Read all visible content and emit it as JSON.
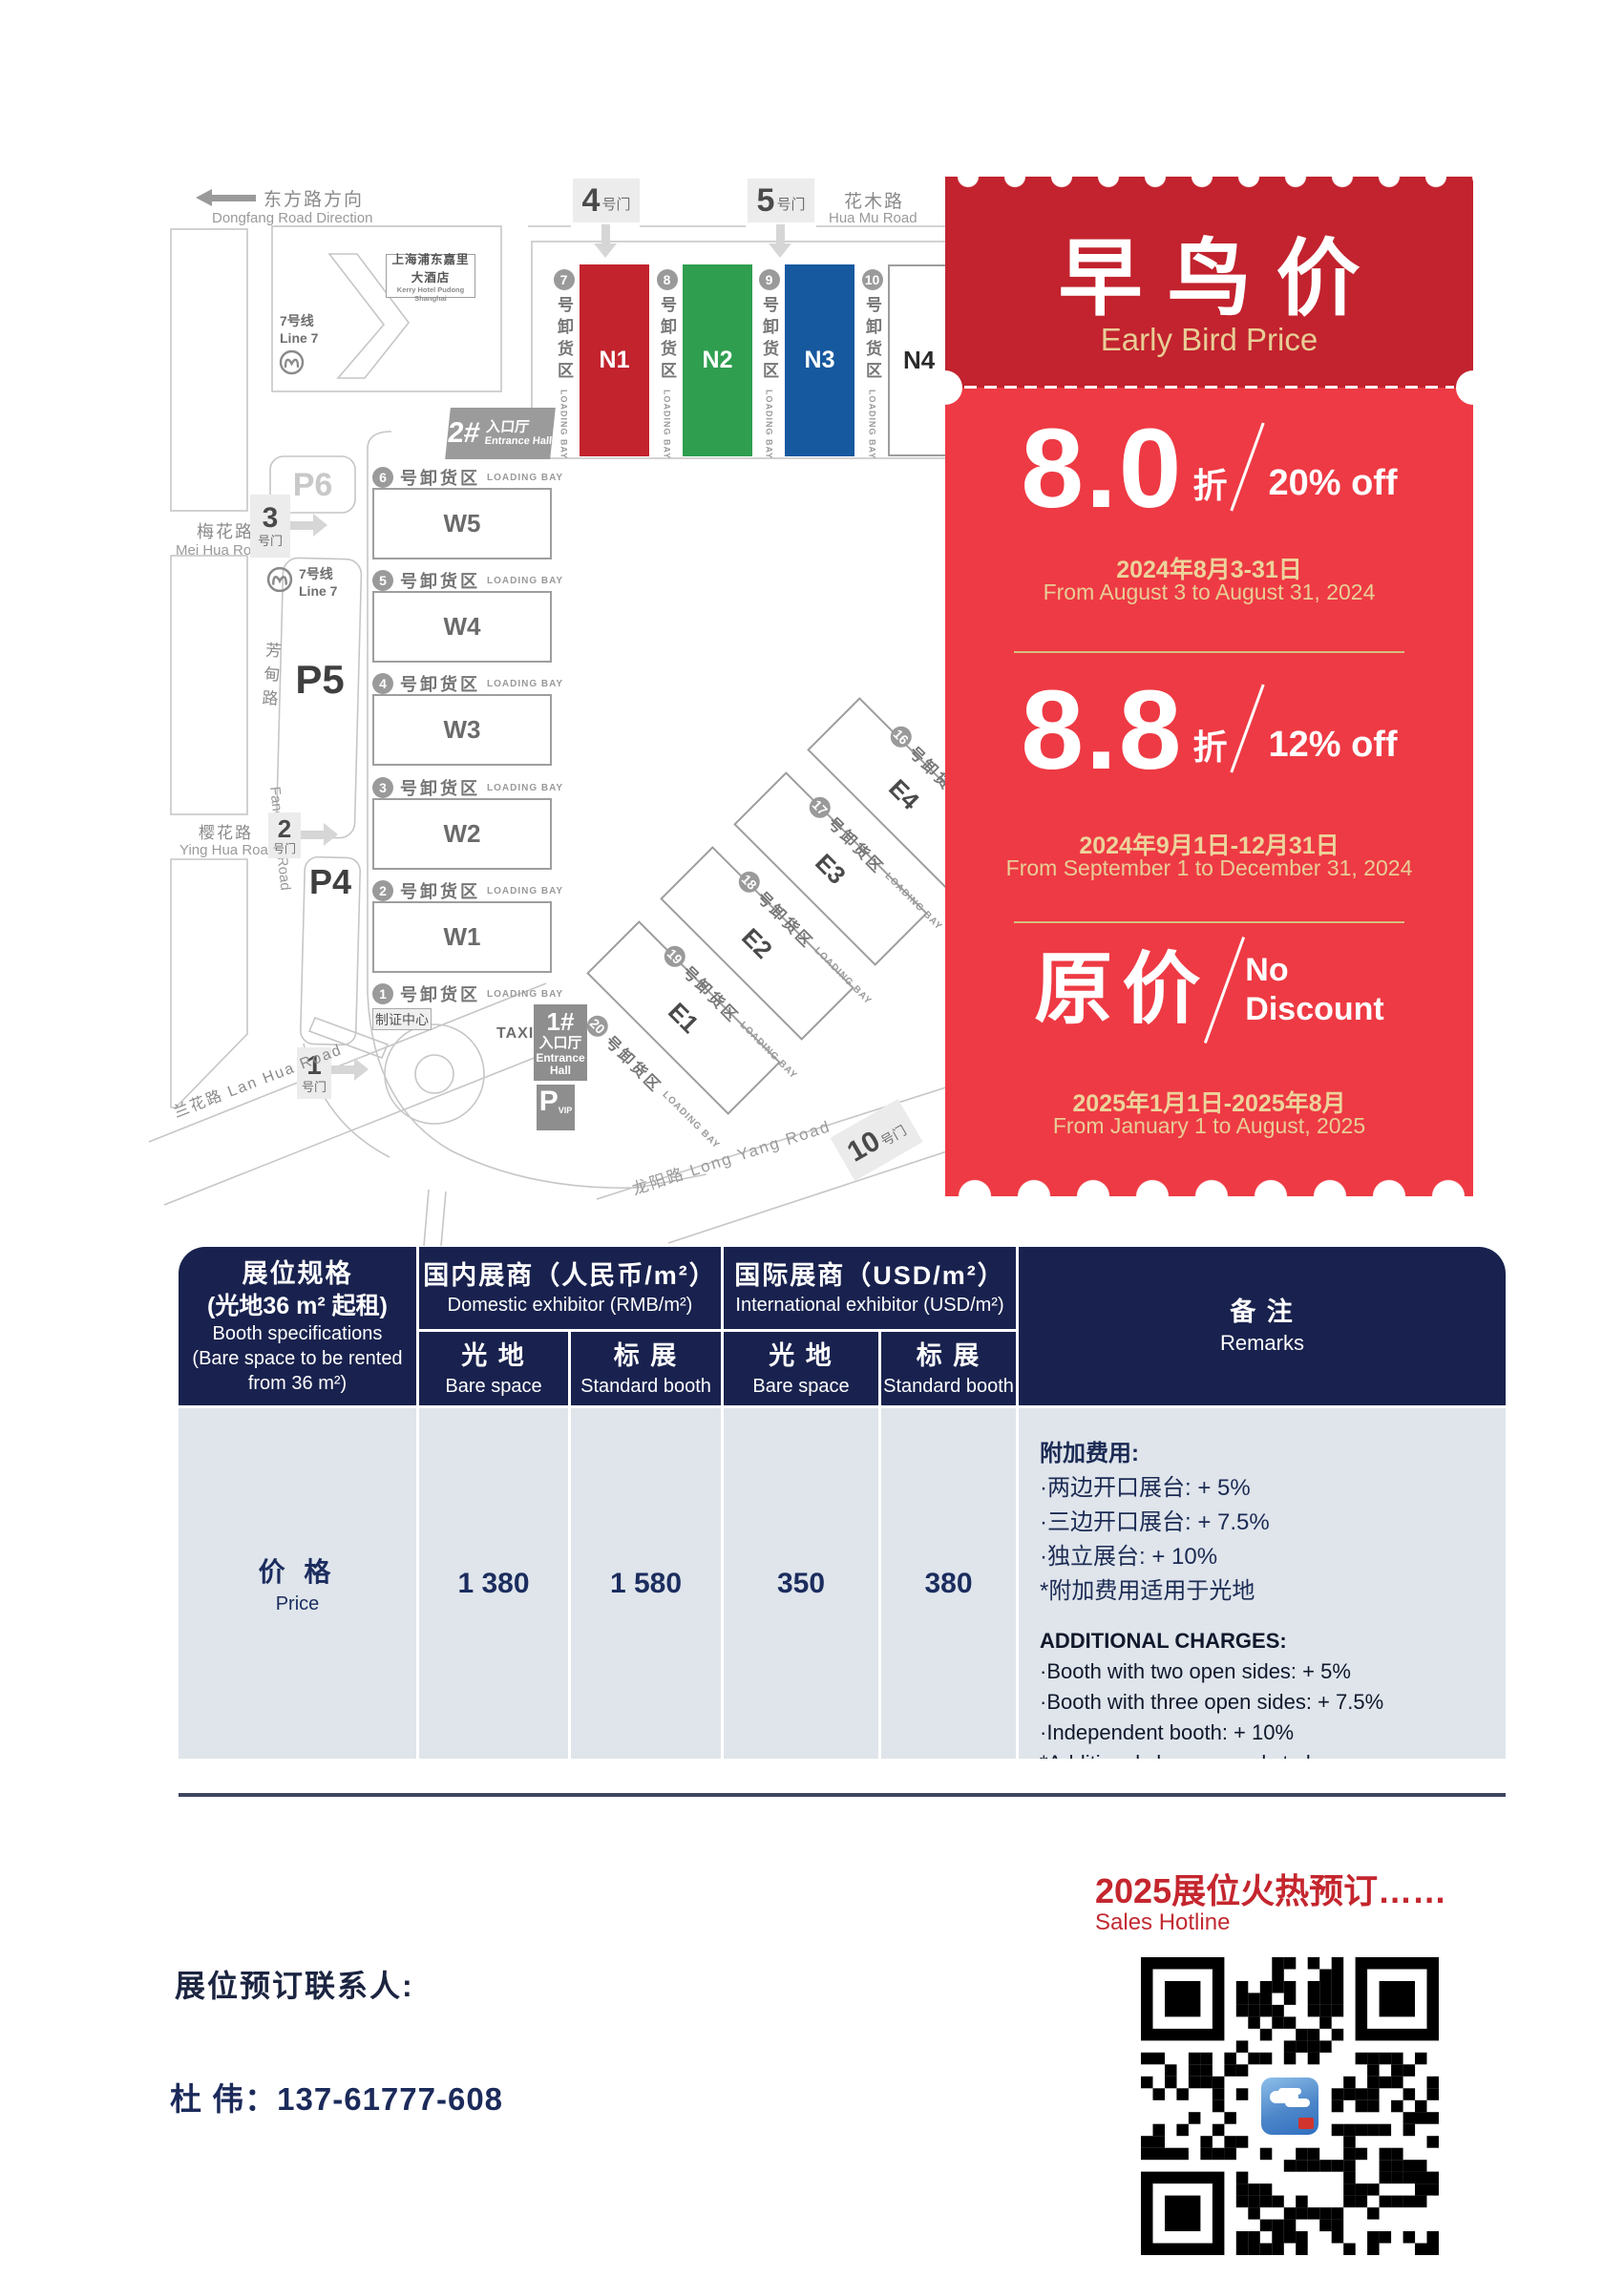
{
  "colors": {
    "coupon_header_red": "#c2232e",
    "coupon_body_red": "#ee3a44",
    "gold": "#e8cd96",
    "gold_line": "#d8bc80",
    "navy": "#19224e",
    "table_body": "#dfe5eb",
    "accent_red": "#c4262e",
    "hall_red": "#c2232d",
    "hall_green": "#2f9e4f",
    "hall_blue": "#17599f"
  },
  "map": {
    "dongfang_zh": "东方路方向",
    "dongfang_en": "Dongfang Road Direction",
    "huamu_zh": "花木路",
    "huamu_en": "Hua Mu Road",
    "meihua_zh": "梅花路",
    "meihua_en": "Mei Hua Road",
    "yinghua_zh": "樱花路",
    "yinghua_en": "Ying Hua Road",
    "lanhua": "兰花路 Lan Hua Road",
    "fangdian_zh": "芳甸路",
    "fangdian_en": "Fang Dian Road",
    "longyang": "龙阳路 Long Yang Road",
    "hotel_zh": "上海浦东嘉里大酒店",
    "hotel_en": "Kerry Hotel Pudong Shanghai",
    "line7_zh": "7号线",
    "line7_en": "Line 7",
    "gate_suffix": "号门",
    "gates": {
      "g1": "1",
      "g2": "2",
      "g3": "3",
      "g4": "4",
      "g5": "5",
      "g10": "10"
    },
    "parking": {
      "p4": "P4",
      "p5": "P5",
      "p6": "P6",
      "vip_p": "P",
      "vip_sub": "VIP"
    },
    "ent2_num": "2#",
    "ent1_num": "1#",
    "ent_zh": "入口厅",
    "ent_en": "Entrance Hall",
    "ent_en1": "Entrance",
    "ent_en2": "Hall",
    "badge_center": "制证中心",
    "taxi": "TAXI",
    "halls": {
      "n1": "N1",
      "n2": "N2",
      "n3": "N3",
      "n4": "N4",
      "w1": "W1",
      "w2": "W2",
      "w3": "W3",
      "w4": "W4",
      "w5": "W5",
      "e1": "E1",
      "e2": "E2",
      "e3": "E3",
      "e4": "E4"
    },
    "bay_zh": "号卸货区",
    "bay_en": "LOADING BAY",
    "bays_n": [
      "7",
      "8",
      "9",
      "10"
    ],
    "bays_w": [
      "6",
      "5",
      "4",
      "3",
      "2",
      "1"
    ],
    "bays_e": [
      "16",
      "17",
      "18",
      "19",
      "20"
    ]
  },
  "coupon": {
    "title_zh": "早鸟价",
    "title_en": "Early Bird Price",
    "tier1": {
      "value": "8.0",
      "unit": "折",
      "off": "20% off",
      "period_zh": "2024年8月3-31日",
      "period_en": "From August 3 to August 31, 2024"
    },
    "tier2": {
      "value": "8.8",
      "unit": "折",
      "off": "12% off",
      "period_zh": "2024年9月1日-12月31日",
      "period_en": "From September 1 to December 31, 2024"
    },
    "tier3": {
      "value": "原价",
      "off1": "No",
      "off2": "Discount",
      "period_zh": "2025年1月1日-2025年8月",
      "period_en": "From January 1 to August, 2025"
    }
  },
  "table": {
    "spec_zh": "展位规格",
    "spec_zh2": "(光地36 m² 起租)",
    "spec_en1": "Booth specifications",
    "spec_en2": "(Bare space to be rented",
    "spec_en3": "from 36 m²)",
    "domestic_zh": "国内展商（人民币/m²）",
    "domestic_en": "Domestic exhibitor (RMB/m²)",
    "intl_zh": "国际展商（USD/m²）",
    "intl_en": "International exhibitor (USD/m²)",
    "bare_zh": "光 地",
    "bare_en": "Bare space",
    "std_zh": "标 展",
    "std_en": "Standard booth",
    "remarks_zh": "备 注",
    "remarks_en": "Remarks",
    "price_zh": "价 格",
    "price_en": "Price",
    "price_domestic_bare": "1 380",
    "price_domestic_std": "1 580",
    "price_intl_bare": "350",
    "price_intl_std": "380",
    "remarks_cn": {
      "title": "附加费用:",
      "l1": "·两边开口展台: + 5%",
      "l2": "·三边开口展台: + 7.5%",
      "l3": "·独立展台: + 10%",
      "l4": "*附加费用适用于光地"
    },
    "remarks_en_block": {
      "title": "ADDITIONAL CHARGES:",
      "l1": "·Booth with two open sides: + 5%",
      "l2": "·Booth with three open sides: + 7.5%",
      "l3": "·Independent booth: + 10%",
      "l4": "*Additional charges apply to bare space"
    }
  },
  "footer": {
    "hotline_zh": "2025展位火热预订……",
    "hotline_en": "Sales Hotline",
    "contact_label": "展位预订联系人:",
    "contact_phone": "杜  伟：137-61777-608"
  }
}
